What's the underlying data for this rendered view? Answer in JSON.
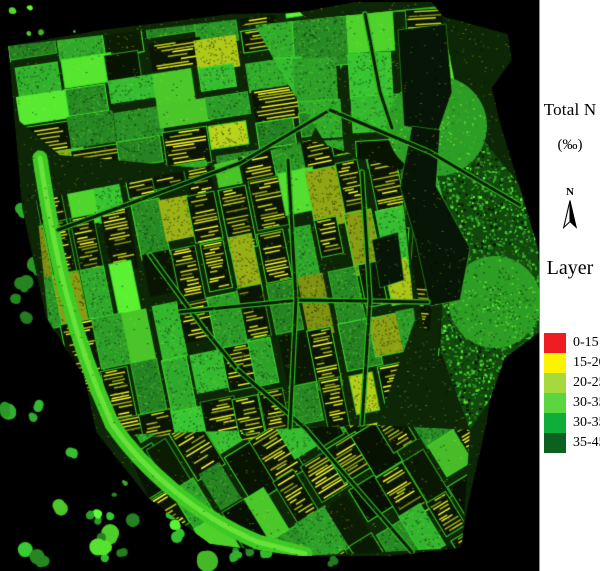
{
  "panel": {
    "title": "Total N",
    "units": "(‰)",
    "north_label": "N",
    "layer_label": "Layer",
    "background": "#ffffff"
  },
  "legend": {
    "items": [
      {
        "label": "0-15",
        "color": "#ee1c23"
      },
      {
        "label": "15-20",
        "color": "#fdf201"
      },
      {
        "label": "20-25",
        "color": "#a6d93e"
      },
      {
        "label": "30-35",
        "color": "#5bd63f"
      },
      {
        "label": "30-35",
        "color": "#0fad3a"
      },
      {
        "label": "35-45",
        "color": "#0c6120"
      }
    ]
  },
  "map": {
    "description": "Classified raster map of total nitrogen (Total N, per mille) over agricultural fields",
    "background": "#000000",
    "palette": {
      "bright_green": "#52d92e",
      "medium_green": "#2ea32a",
      "dark_green": "#145f10",
      "olive": "#9cb317",
      "yellow": "#dde32a",
      "field_border": "#3ee22a",
      "road_dark": "#0a1a04",
      "road_edge": "#2cb81d",
      "canal_green": "#3ec924",
      "shadow": "#061505"
    }
  }
}
